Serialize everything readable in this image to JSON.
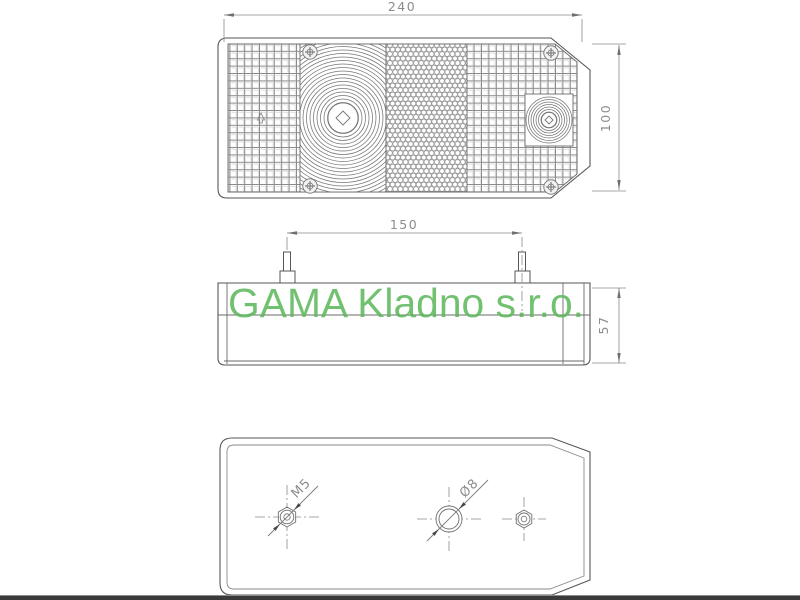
{
  "page": {
    "background": "#ffffff",
    "footer_bar_color": "#3a3a3a",
    "line_color": "#565656",
    "dim_text_color": "#8c8c8c"
  },
  "watermark": {
    "text": "GAMA Kladno s.r.o.",
    "color": "#5cb85c"
  },
  "dimensions": {
    "front_width": "240",
    "front_height": "100",
    "stud_spacing": "150",
    "side_height": "57"
  },
  "annotations": {
    "left_hole_thread": "M5",
    "center_hole_diameter": "Ø8"
  },
  "icons": {
    "screw": "phillips-screw-icon",
    "center_mark": "crosshair-centerline"
  }
}
